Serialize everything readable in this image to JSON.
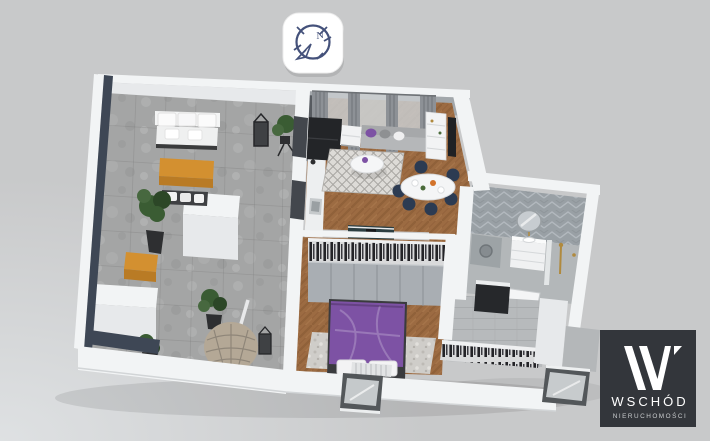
{
  "canvas": {
    "width": 710,
    "height": 441,
    "background": "#c8c9ca"
  },
  "compass_badge": {
    "north_label": "N",
    "background": "#ffffff",
    "stroke_color": "#44517a"
  },
  "brand_logo": {
    "name": "WSCHÓD",
    "tagline": "NIERUCHOMOŚCI",
    "background": "#33363b",
    "text_color": "#ffffff"
  },
  "floorplan": {
    "type": "3d-isometric-apartment-render",
    "rooms": [
      {
        "id": "terrace",
        "floor": "grey-stone-tiles",
        "furniture": [
          "outdoor-sofa",
          "amber-coffee-table",
          "bench",
          "amber-stool",
          "potted-plants",
          "lanterns",
          "hanging-rattan-chair",
          "white-storage-boxes"
        ]
      },
      {
        "id": "living-room-kitchen",
        "floor": "herringbone-wood",
        "furniture": [
          "grey-curtains",
          "charcoal-chaise-sofa",
          "white-armchair",
          "grey-sofa-purple-pillow",
          "patterned-rug",
          "round-coffee-table",
          "oval-dining-table",
          "navy-dining-chairs",
          "shelf-unit",
          "tv-panel",
          "kitchenette-with-sink",
          "dark-sideboard"
        ]
      },
      {
        "id": "bedroom",
        "floor": "herringbone-wood",
        "furniture": [
          "purple-double-bed",
          "wardrobe-with-hanging-clothes",
          "shaggy-rug",
          "radiator",
          "tilt-window"
        ]
      },
      {
        "id": "bathroom",
        "floor": "grey-tiles",
        "furniture": [
          "washing-machine",
          "white-vanity",
          "round-mirror",
          "gold-shower-set",
          "glass-partition",
          "white-door"
        ]
      },
      {
        "id": "entrance-hall",
        "floor": "grey-planks",
        "furniture": [
          "open-wardrobe-clothes-rail",
          "shaft-box",
          "tilt-window"
        ]
      }
    ],
    "colors": {
      "wall_top": "#f2f4f5",
      "wall_face": "#e7e9eb",
      "wall_shadow": "#a2a7ab",
      "dark_wall": "#3e4755",
      "terrace_floor": "#a4a5a5",
      "wood_floor": "#9c6b42",
      "wood_floor_dark": "#865833",
      "hall_floor": "#b7babc",
      "bath_floor": "#b3b7b9",
      "bath_tile": "#99a0a5",
      "accent_purple": "#7d52a4",
      "accent_amber": "#d39030",
      "plant_green": "#3a5c33",
      "furniture_charcoal": "#232528",
      "curtain_gray": "#8d9196",
      "chair_navy": "#2c3b52",
      "rug_light": "#dddbd7",
      "wardrobe_gray": "#a9aeb3",
      "gold": "#b08a3e"
    }
  }
}
